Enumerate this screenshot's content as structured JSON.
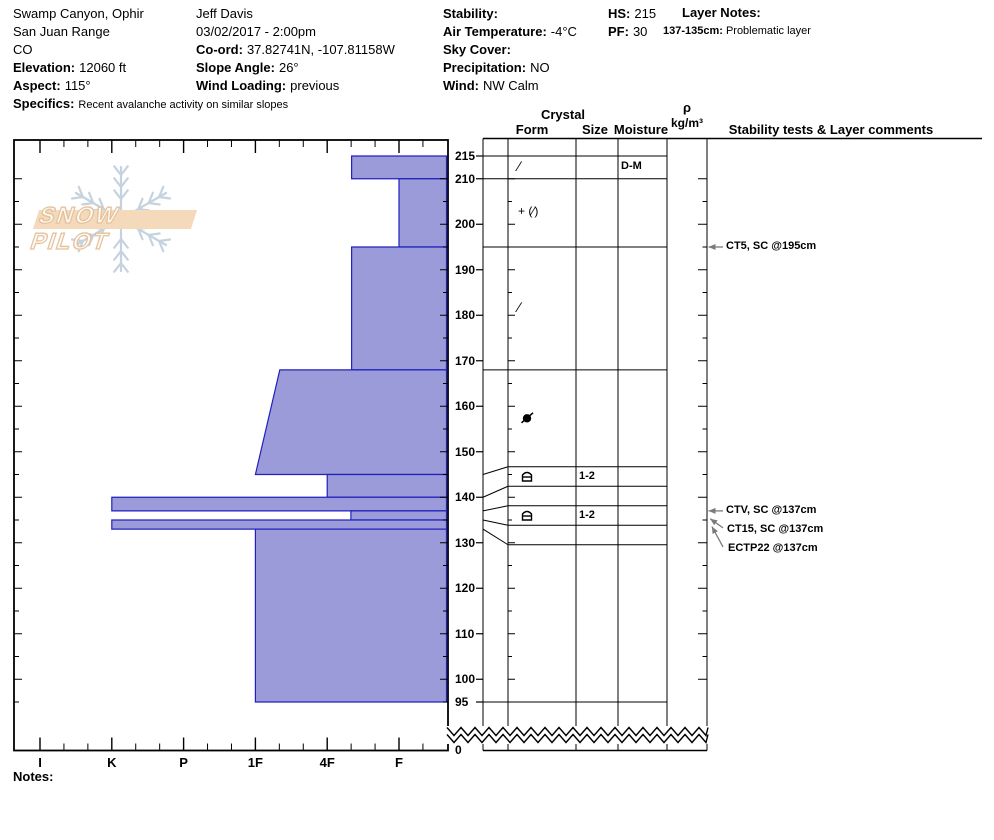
{
  "header": {
    "columns": [
      {
        "id": "location",
        "lines": [
          {
            "label": "",
            "value": "Swamp Canyon, Ophir"
          },
          {
            "label": "",
            "value": "San Juan Range"
          },
          {
            "label": "",
            "value": "CO"
          },
          {
            "label": "Elevation:",
            "value": "12060 ft"
          },
          {
            "label": "Aspect:",
            "value": "115°"
          },
          {
            "label": "Specifics:",
            "value": "Recent avalanche activity on similar slopes",
            "small": true
          }
        ]
      },
      {
        "id": "observer",
        "lines": [
          {
            "label": "",
            "value": "Jeff Davis"
          },
          {
            "label": "",
            "value": "03/02/2017 - 2:00pm"
          },
          {
            "label": "Co-ord:",
            "value": "37.82741N, -107.81158W"
          },
          {
            "label": "Slope Angle:",
            "value": "26°"
          },
          {
            "label": "Wind Loading:",
            "value": "previous"
          }
        ]
      },
      {
        "id": "weather",
        "lines": [
          {
            "label": "Stability:",
            "value": ""
          },
          {
            "label": "Air Temperature:",
            "value": "-4°C"
          },
          {
            "label": "Sky Cover:",
            "value": ""
          },
          {
            "label": "Precipitation:",
            "value": "NO"
          },
          {
            "label": "Wind:",
            "value": "NW Calm"
          }
        ]
      },
      {
        "id": "totals",
        "lines": [
          {
            "label": "HS:",
            "value": "215"
          },
          {
            "label": "PF:",
            "value": "30"
          }
        ]
      }
    ],
    "layer_notes": {
      "title": "Layer Notes:",
      "entries": [
        {
          "label": "137-135cm:",
          "value": "Problematic layer"
        }
      ]
    }
  },
  "logo": {
    "text": "SNOW PILOT",
    "snowflake_icon": "snowflake-icon"
  },
  "table": {
    "headers": {
      "crystal": "Crystal",
      "form": "Form",
      "size": "Size",
      "moisture": "Moisture",
      "rho": "ρ",
      "rho_unit": "kg/m³",
      "stability": "Stability tests & Layer comments"
    }
  },
  "notes_label": "Notes:",
  "chart_data": {
    "type": "bar",
    "title": "Snow profile: hand hardness vs depth",
    "orientation": "horizontal-bars-from-right",
    "depth_axis": {
      "unit": "cm",
      "tick_labels": [
        "215",
        "210",
        "200",
        "190",
        "180",
        "170",
        "160",
        "150",
        "140",
        "130",
        "120",
        "110",
        "100",
        "95"
      ],
      "ground_label": "0",
      "surface": 215,
      "lowest_drawn": 95
    },
    "hardness_axis": {
      "labels": [
        "I",
        "K",
        "P",
        "1F",
        "4F",
        "F"
      ],
      "note": "hardest (I) at left, softest (F) at right"
    },
    "hs_cm": "215",
    "layers": [
      {
        "top": 215,
        "bottom": 210,
        "hardness": "4F-",
        "h_top": 1.66,
        "h_bot": 1.66,
        "form": {
          "kind": "text",
          "text": "∕",
          "name": "decomposing-fragments-symbol"
        },
        "size": "",
        "moisture": "D-M"
      },
      {
        "top": 210,
        "bottom": 195,
        "hardness": "F",
        "h_top": 1.0,
        "h_bot": 1.0,
        "form": {
          "kind": "text",
          "text": "+ (∕)",
          "name": "precip-particles-with-fragments-symbol"
        },
        "size": "",
        "moisture": ""
      },
      {
        "top": 195,
        "bottom": 168,
        "hardness": "4F-",
        "h_top": 1.66,
        "h_bot": 1.66,
        "form": {
          "kind": "text",
          "text": "∕",
          "name": "decomposing-fragments-symbol"
        },
        "size": "",
        "moisture": ""
      },
      {
        "top": 168,
        "bottom": 145,
        "hardness": "1F- to 1F",
        "h_top": 2.66,
        "h_bot": 3.0,
        "form": {
          "kind": "glyph",
          "glyph": "circle-slash",
          "name": "rounded-grains-mixed-symbol"
        },
        "size": "",
        "moisture": ""
      },
      {
        "top": 145,
        "bottom": 140,
        "hardness": "4F",
        "h_top": 2.0,
        "h_bot": 2.0,
        "form": {
          "kind": "glyph",
          "glyph": "crust-arch",
          "name": "crust-symbol"
        },
        "size": "1-2",
        "moisture": ""
      },
      {
        "top": 140,
        "bottom": 137,
        "hardness": "K",
        "h_top": 5.0,
        "h_bot": 5.0,
        "form": {
          "kind": "none"
        },
        "size": "",
        "moisture": ""
      },
      {
        "top": 137,
        "bottom": 135,
        "hardness": "4F-",
        "h_top": 1.67,
        "h_bot": 1.67,
        "form": {
          "kind": "glyph",
          "glyph": "crust-arch",
          "name": "crust-symbol"
        },
        "size": "1-2",
        "moisture": ""
      },
      {
        "top": 135,
        "bottom": 133,
        "hardness": "K",
        "h_top": 5.0,
        "h_bot": 5.0,
        "form": {
          "kind": "none"
        },
        "size": "",
        "moisture": ""
      },
      {
        "top": 133,
        "bottom": 95,
        "hardness": "1F",
        "h_top": 3.0,
        "h_bot": 3.0,
        "form": {
          "kind": "none"
        },
        "size": "",
        "moisture": ""
      }
    ],
    "annotations": [
      {
        "text": "CT5, SC @195cm",
        "depth": 195
      },
      {
        "text": "CTV, SC @137cm",
        "depth": 137
      },
      {
        "text": "CT15, SC @137cm",
        "depth": 137
      },
      {
        "text": "ECTP22 @137cm",
        "depth": 137
      }
    ],
    "colors": {
      "bar_fill": "#9b9bd9",
      "bar_stroke": "#2020bf",
      "line": "#000000",
      "arrow": "#7a7a7a"
    }
  }
}
